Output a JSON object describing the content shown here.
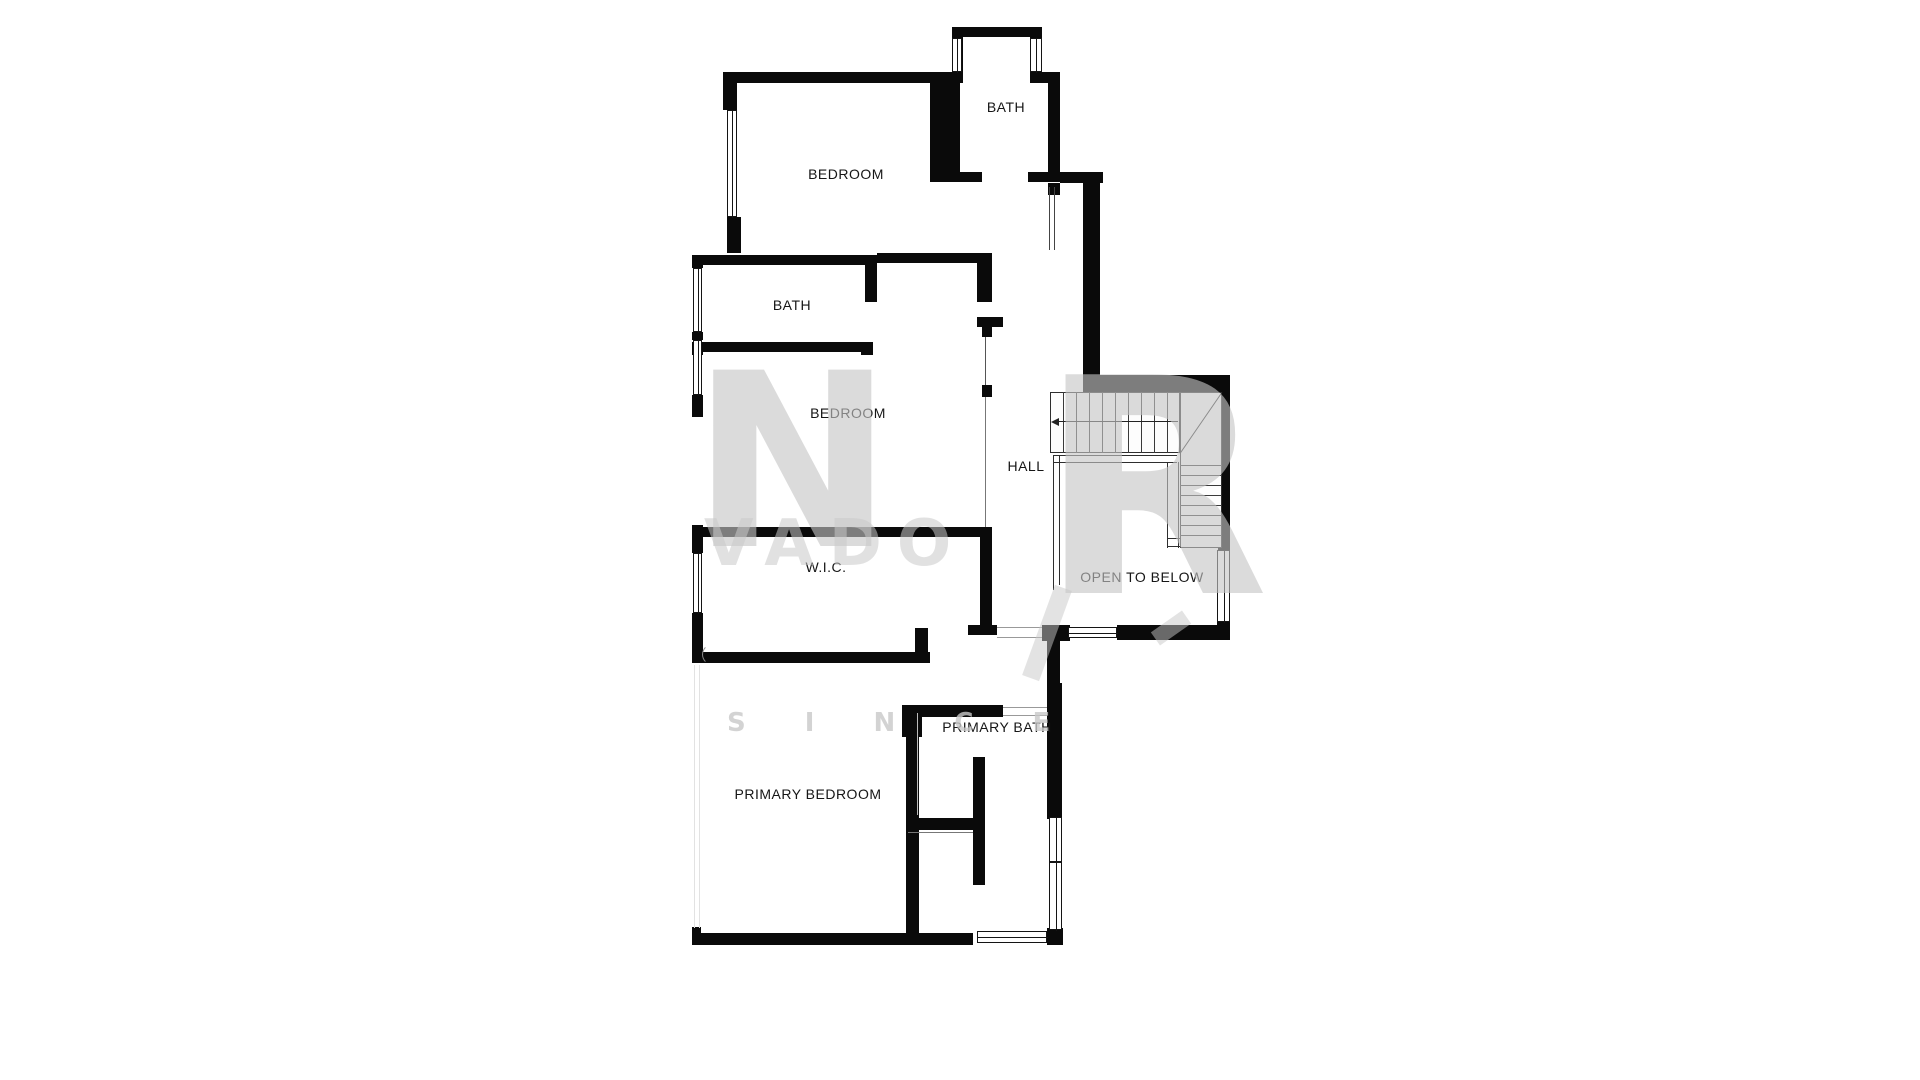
{
  "plan": {
    "wall_color": "#0a0a0a",
    "rooms": [
      {
        "label": "BATH",
        "x": 1006,
        "y": 107
      },
      {
        "label": "BEDROOM",
        "x": 846,
        "y": 174
      },
      {
        "label": "BATH",
        "x": 792,
        "y": 305
      },
      {
        "label": "BEDROOM",
        "x": 848,
        "y": 413
      },
      {
        "label": "HALL",
        "x": 1026,
        "y": 466
      },
      {
        "label": "W.I.C.",
        "x": 826,
        "y": 567
      },
      {
        "label": "OPEN TO BELOW",
        "x": 1142,
        "y": 577
      },
      {
        "label": "PRIMARY BATH",
        "x": 997,
        "y": 727
      },
      {
        "label": "PRIMARY BEDROOM",
        "x": 808,
        "y": 794
      }
    ],
    "walls": [
      [
        952,
        27,
        88,
        10
      ],
      [
        952,
        27,
        11,
        56
      ],
      [
        1030,
        27,
        12,
        56
      ],
      [
        1030,
        72,
        30,
        11
      ],
      [
        1048,
        72,
        12,
        105
      ],
      [
        958,
        172,
        24,
        10
      ],
      [
        1028,
        172,
        35,
        10
      ],
      [
        1060,
        172,
        43,
        11
      ],
      [
        1083,
        183,
        17,
        209
      ],
      [
        1048,
        183,
        12,
        12
      ],
      [
        728,
        72,
        235,
        11
      ],
      [
        723,
        72,
        14,
        38
      ],
      [
        727,
        217,
        14,
        36
      ],
      [
        930,
        83,
        30,
        99
      ],
      [
        692,
        255,
        173,
        10
      ],
      [
        865,
        255,
        12,
        47
      ],
      [
        877,
        253,
        115,
        10
      ],
      [
        977,
        253,
        15,
        49
      ],
      [
        977,
        317,
        26,
        10
      ],
      [
        982,
        325,
        10,
        12
      ],
      [
        982,
        385,
        10,
        12
      ],
      [
        692,
        255,
        11,
        13
      ],
      [
        692,
        332,
        11,
        8
      ],
      [
        692,
        395,
        11,
        22
      ],
      [
        692,
        342,
        11,
        13
      ],
      [
        703,
        342,
        170,
        10
      ],
      [
        861,
        342,
        12,
        13
      ],
      [
        692,
        525,
        11,
        28
      ],
      [
        692,
        613,
        11,
        50
      ],
      [
        692,
        527,
        290,
        10
      ],
      [
        980,
        527,
        12,
        100
      ],
      [
        968,
        625,
        29,
        10
      ],
      [
        703,
        652,
        227,
        11
      ],
      [
        915,
        628,
        13,
        35
      ],
      [
        1095,
        375,
        135,
        17
      ],
      [
        1218,
        375,
        12,
        177
      ],
      [
        1217,
        620,
        13,
        20
      ],
      [
        1042,
        625,
        28,
        16
      ],
      [
        1117,
        625,
        113,
        15
      ],
      [
        902,
        705,
        20,
        32
      ],
      [
        906,
        705,
        13,
        240
      ],
      [
        919,
        705,
        84,
        12
      ],
      [
        1047,
        640,
        13,
        45
      ],
      [
        1047,
        683,
        15,
        136
      ],
      [
        1047,
        928,
        16,
        17
      ],
      [
        973,
        757,
        12,
        128
      ],
      [
        908,
        818,
        65,
        12
      ],
      [
        692,
        933,
        281,
        12
      ],
      [
        692,
        927,
        9,
        18
      ]
    ],
    "windows": [
      [
        952,
        38,
        10,
        34,
        "v"
      ],
      [
        1030,
        38,
        12,
        34,
        "v"
      ],
      [
        727,
        110,
        10,
        107,
        "v"
      ],
      [
        693,
        268,
        9,
        64,
        "v"
      ],
      [
        693,
        340,
        9,
        55,
        "v"
      ],
      [
        693,
        553,
        9,
        60,
        "v"
      ],
      [
        1217,
        550,
        13,
        72,
        "v"
      ],
      [
        1068,
        627,
        49,
        11,
        "h"
      ],
      [
        1049,
        817,
        13,
        113,
        "v"
      ],
      [
        977,
        931,
        70,
        12,
        "h"
      ]
    ],
    "lines": [
      [
        1049,
        187,
        1,
        63,
        "#444"
      ],
      [
        1054,
        187,
        1,
        63,
        "#444"
      ],
      [
        985,
        337,
        1,
        48,
        "#555"
      ],
      [
        985,
        397,
        1,
        130,
        "#777"
      ],
      [
        997,
        627,
        45,
        1,
        "#999"
      ],
      [
        997,
        637,
        45,
        1,
        "#999"
      ],
      [
        1003,
        707,
        44,
        1,
        "#999"
      ],
      [
        1003,
        715,
        44,
        1,
        "#999"
      ],
      [
        917,
        713,
        1,
        102,
        "#bbb"
      ],
      [
        908,
        832,
        65,
        1,
        "#777"
      ],
      [
        694,
        665,
        1,
        263,
        "#e2e2e2"
      ],
      [
        699,
        665,
        1,
        263,
        "#e2e2e2"
      ],
      [
        1049,
        861,
        13,
        2,
        "#141414"
      ],
      [
        1053,
        455,
        124,
        1,
        "#2e2e2e"
      ],
      [
        1053,
        462,
        124,
        1,
        "#2e2e2e"
      ],
      [
        1053,
        455,
        1,
        135,
        "#2e2e2e"
      ],
      [
        1059,
        455,
        1,
        130,
        "#2e2e2e"
      ],
      [
        1167,
        462,
        1,
        86,
        "#2e2e2e"
      ],
      [
        1178,
        462,
        1,
        86,
        "#2e2e2e"
      ],
      [
        1167,
        538,
        55,
        1,
        "#2e2e2e"
      ],
      [
        1167,
        546,
        55,
        1,
        "#2e2e2e"
      ]
    ],
    "stairs": {
      "upper_box": {
        "x": 1050,
        "y": 392,
        "w": 130,
        "h": 61
      },
      "right_box": {
        "x": 1180,
        "y": 392,
        "w": 42,
        "h": 156
      },
      "treads_vertical": {
        "x0": 1063,
        "step": 13,
        "count": 9,
        "y": 392,
        "h": 61
      },
      "treads_horizontal": {
        "y0": 465,
        "step": 10,
        "count": 8,
        "x": 1180,
        "w": 42
      },
      "diagonal": {
        "x": 1180,
        "y": 453,
        "len": 74,
        "angle": -55.5
      },
      "arrow": {
        "x": 1058,
        "y": 421,
        "len": 120
      }
    },
    "watermark": {
      "monogram_left": "N",
      "monogram_right": "R",
      "word": "VADO",
      "row": "S I N C E"
    }
  }
}
